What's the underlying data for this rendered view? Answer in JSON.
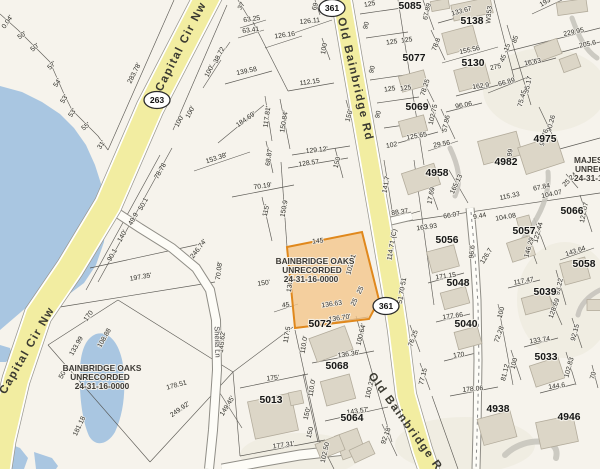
{
  "map": {
    "palette": {
      "background": "#f6f3ec",
      "road_fill": "#f2eda1",
      "road_casing": "#9a9890",
      "water": "#a9c6e1",
      "selected_fill": "#f4c488",
      "selected_border": "#e0881c",
      "building_fill": "#dcd6c7"
    },
    "roads": {
      "capital_cir": {
        "name": "Capital Cir Nw",
        "shield": "263"
      },
      "old_bainbridge": {
        "name": "Old Bainbridge Rd",
        "shield": "361"
      },
      "sheila_ln": {
        "name": "Sheila Ln"
      }
    },
    "subdivisions": {
      "bainbridge_oaks": {
        "line1": "BAINBRIDGE OAKS",
        "line2": "UNRECORDED",
        "line3": "24-31-16-0000"
      },
      "majestic": {
        "line1": "MAJESTIC",
        "line2": "UNRECORDED",
        "line3": "24-31-16-0000"
      }
    },
    "selected_parcel": {
      "dimensions": [
        "145",
        "102.21",
        "25",
        "25",
        "136.63",
        "130.1"
      ]
    },
    "parcel_numbers": [
      {
        "t": "5085",
        "x": 410,
        "y": 9
      },
      {
        "t": "5138",
        "x": 472,
        "y": 24
      },
      {
        "t": "5077",
        "x": 414,
        "y": 61
      },
      {
        "t": "5130",
        "x": 473,
        "y": 66
      },
      {
        "t": "5069",
        "x": 417,
        "y": 110
      },
      {
        "t": "4982",
        "x": 506,
        "y": 165
      },
      {
        "t": "4975",
        "x": 545,
        "y": 142
      },
      {
        "t": "5066",
        "x": 572,
        "y": 214
      },
      {
        "t": "4958",
        "x": 437,
        "y": 176
      },
      {
        "t": "5057",
        "x": 524,
        "y": 234
      },
      {
        "t": "5056",
        "x": 447,
        "y": 243
      },
      {
        "t": "5058",
        "x": 584,
        "y": 267
      },
      {
        "t": "5048",
        "x": 458,
        "y": 286
      },
      {
        "t": "5039",
        "x": 545,
        "y": 295
      },
      {
        "t": "5040",
        "x": 466,
        "y": 327
      },
      {
        "t": "5033",
        "x": 546,
        "y": 360
      },
      {
        "t": "4938",
        "x": 498,
        "y": 412
      },
      {
        "t": "4946",
        "x": 569,
        "y": 420
      },
      {
        "t": "5072",
        "x": 320,
        "y": 327
      },
      {
        "t": "5068",
        "x": 337,
        "y": 369
      },
      {
        "t": "5064",
        "x": 352,
        "y": 421
      },
      {
        "t": "5013",
        "x": 271,
        "y": 403
      }
    ],
    "measurements": [
      {
        "t": "0.04'",
        "x": 9,
        "y": 23,
        "r": -55
      },
      {
        "t": "50'",
        "x": 23,
        "y": 37,
        "r": -35
      },
      {
        "t": "50'",
        "x": 36,
        "y": 49,
        "r": -40
      },
      {
        "t": "57'",
        "x": 53,
        "y": 67,
        "r": -42
      },
      {
        "t": "54'",
        "x": 59,
        "y": 84,
        "r": -55
      },
      {
        "t": "53'",
        "x": 66,
        "y": 100,
        "r": -58
      },
      {
        "t": "53'",
        "x": 74,
        "y": 114,
        "r": -55
      },
      {
        "t": "55'",
        "x": 87,
        "y": 128,
        "r": -38
      },
      {
        "t": "31'",
        "x": 103,
        "y": 146,
        "r": -55
      },
      {
        "t": "283.78'",
        "x": 136,
        "y": 74,
        "r": -63
      },
      {
        "t": "100'",
        "x": 181,
        "y": 122,
        "r": -63
      },
      {
        "t": "100'",
        "x": 192,
        "y": 113,
        "r": -63
      },
      {
        "t": "38.72",
        "x": 221,
        "y": 56,
        "r": -63
      },
      {
        "t": "100'",
        "x": 211,
        "y": 72,
        "r": -63
      },
      {
        "t": "37",
        "x": 243,
        "y": 7,
        "r": -60
      },
      {
        "t": "63.25",
        "x": 252,
        "y": 21,
        "r": -8
      },
      {
        "t": "63.41",
        "x": 251,
        "y": 32,
        "r": -8
      },
      {
        "t": "126.11",
        "x": 310,
        "y": 23,
        "r": -6
      },
      {
        "t": "126.16",
        "x": 285,
        "y": 37,
        "r": -8
      },
      {
        "t": "69",
        "x": 317,
        "y": 7,
        "r": -75
      },
      {
        "t": "100",
        "x": 326,
        "y": 49,
        "r": -80
      },
      {
        "t": "139.58",
        "x": 247,
        "y": 73,
        "r": -12
      },
      {
        "t": "112.15",
        "x": 310,
        "y": 84,
        "r": -8
      },
      {
        "t": "184.69'",
        "x": 247,
        "y": 121,
        "r": -35
      },
      {
        "t": "117.81'",
        "x": 269,
        "y": 117,
        "r": -82
      },
      {
        "t": "150.84'",
        "x": 286,
        "y": 122,
        "r": -80
      },
      {
        "t": "150'",
        "x": 351,
        "y": 116,
        "r": -75
      },
      {
        "t": "68.87'",
        "x": 271,
        "y": 157,
        "r": -82
      },
      {
        "t": "129.12'",
        "x": 317,
        "y": 152,
        "r": -6
      },
      {
        "t": "128.57",
        "x": 309,
        "y": 165,
        "r": -8
      },
      {
        "t": "150",
        "x": 339,
        "y": 163,
        "r": -75
      },
      {
        "t": "153.38'",
        "x": 217,
        "y": 160,
        "r": -18
      },
      {
        "t": "70.19'",
        "x": 263,
        "y": 188,
        "r": -8
      },
      {
        "t": "115'",
        "x": 268,
        "y": 211,
        "r": -77
      },
      {
        "t": "150.9",
        "x": 286,
        "y": 209,
        "r": -80
      },
      {
        "t": "246.74'",
        "x": 200,
        "y": 250,
        "r": -52
      },
      {
        "t": "70.08'",
        "x": 221,
        "y": 271,
        "r": -83
      },
      {
        "t": "145.62'",
        "x": 224,
        "y": 342,
        "r": -84
      },
      {
        "t": "197.35'",
        "x": 141,
        "y": 279,
        "r": -10
      },
      {
        "t": "78.78",
        "x": 162,
        "y": 172,
        "r": -60
      },
      {
        "t": "50.1",
        "x": 145,
        "y": 205,
        "r": -60
      },
      {
        "t": "49.9",
        "x": 135,
        "y": 220,
        "r": -60
      },
      {
        "t": "140'",
        "x": 124,
        "y": 237,
        "r": -60
      },
      {
        "t": "90.1",
        "x": 114,
        "y": 256,
        "r": -60
      },
      {
        "t": "170",
        "x": 90,
        "y": 317,
        "r": -55
      },
      {
        "t": "108.88",
        "x": 106,
        "y": 339,
        "r": -60
      },
      {
        "t": "133.99",
        "x": 78,
        "y": 347,
        "r": -60
      },
      {
        "t": "50",
        "x": 64,
        "y": 376,
        "r": -60
      },
      {
        "t": "178.51",
        "x": 177,
        "y": 387,
        "r": -15
      },
      {
        "t": "249.92'",
        "x": 181,
        "y": 411,
        "r": -35
      },
      {
        "t": "181.18",
        "x": 81,
        "y": 427,
        "r": -65
      },
      {
        "t": "150'",
        "x": 264,
        "y": 285,
        "r": -8
      },
      {
        "t": "45",
        "x": 286,
        "y": 307,
        "r": -8
      },
      {
        "t": "117.5",
        "x": 289,
        "y": 335,
        "r": -80
      },
      {
        "t": "175'",
        "x": 273,
        "y": 380,
        "r": -6
      },
      {
        "t": "149.45'",
        "x": 229,
        "y": 407,
        "r": -58
      },
      {
        "t": "177.31'",
        "x": 284,
        "y": 447,
        "r": -8
      },
      {
        "t": "145",
        "x": 318,
        "y": 243,
        "r": -6
      },
      {
        "t": "102.21",
        "x": 353,
        "y": 265,
        "r": -75
      },
      {
        "t": "130.1",
        "x": 292,
        "y": 284,
        "r": -82
      },
      {
        "t": "136.63",
        "x": 332,
        "y": 306,
        "r": -8
      },
      {
        "t": "25",
        "x": 362,
        "y": 291,
        "r": -62
      },
      {
        "t": "25",
        "x": 356,
        "y": 303,
        "r": -62
      },
      {
        "t": "141.7",
        "x": 388,
        "y": 185,
        "r": -80
      },
      {
        "t": "88.37",
        "x": 400,
        "y": 214,
        "r": -8
      },
      {
        "t": "114.71 (C)",
        "x": 394,
        "y": 245,
        "r": -80
      },
      {
        "t": "51 70 51",
        "x": 404,
        "y": 291,
        "r": -80
      },
      {
        "t": "102",
        "x": 392,
        "y": 147,
        "r": -10
      },
      {
        "t": "136.70'",
        "x": 340,
        "y": 320,
        "r": -8
      },
      {
        "t": "100.64'",
        "x": 363,
        "y": 335,
        "r": -76
      },
      {
        "t": "136.36'",
        "x": 349,
        "y": 356,
        "r": -8
      },
      {
        "t": "110.0'",
        "x": 306,
        "y": 345,
        "r": -80
      },
      {
        "t": "110.0'",
        "x": 314,
        "y": 388,
        "r": -80
      },
      {
        "t": "100.22'",
        "x": 372,
        "y": 388,
        "r": -76
      },
      {
        "t": "143.57'",
        "x": 358,
        "y": 413,
        "r": -8
      },
      {
        "t": "92.18'",
        "x": 388,
        "y": 436,
        "r": -70
      },
      {
        "t": "102.50",
        "x": 327,
        "y": 453,
        "r": -77
      },
      {
        "t": "150'",
        "x": 309,
        "y": 414,
        "r": -76
      },
      {
        "t": "150",
        "x": 312,
        "y": 433,
        "r": -76
      },
      {
        "t": "125",
        "x": 370,
        "y": 6,
        "r": -10
      },
      {
        "t": "90",
        "x": 368,
        "y": 26,
        "r": -75
      },
      {
        "t": "125",
        "x": 392,
        "y": 44,
        "r": -8
      },
      {
        "t": "90",
        "x": 374,
        "y": 70,
        "r": -75
      },
      {
        "t": "125",
        "x": 390,
        "y": 91,
        "r": -8
      },
      {
        "t": "90",
        "x": 380,
        "y": 115,
        "r": -75
      },
      {
        "t": "67.89",
        "x": 429,
        "y": 12,
        "r": -77
      },
      {
        "t": "133.67",
        "x": 462,
        "y": 13,
        "r": -15
      },
      {
        "t": "78.8",
        "x": 438,
        "y": 45,
        "r": -70
      },
      {
        "t": "155.56",
        "x": 470,
        "y": 52,
        "r": -12
      },
      {
        "t": "78.25",
        "x": 427,
        "y": 88,
        "r": -72
      },
      {
        "t": "102.75",
        "x": 435,
        "y": 115,
        "r": -77
      },
      {
        "t": "57.86",
        "x": 448,
        "y": 124,
        "r": -78
      },
      {
        "t": "96.06",
        "x": 464,
        "y": 107,
        "r": -10
      },
      {
        "t": "162.9",
        "x": 481,
        "y": 88,
        "r": -8
      },
      {
        "t": "66.89",
        "x": 507,
        "y": 84,
        "r": -15
      },
      {
        "t": "125",
        "x": 407,
        "y": 42,
        "r": -8
      },
      {
        "t": "125",
        "x": 406,
        "y": 90,
        "r": -8
      },
      {
        "t": "125.65",
        "x": 417,
        "y": 138,
        "r": -10
      },
      {
        "t": "29.56",
        "x": 442,
        "y": 146,
        "r": -10
      },
      {
        "t": "193",
        "x": 546,
        "y": 4,
        "r": -30
      },
      {
        "t": "229.95",
        "x": 574,
        "y": 34,
        "r": -12
      },
      {
        "t": "205.6",
        "x": 588,
        "y": 46,
        "r": -12
      },
      {
        "t": "16 63",
        "x": 533,
        "y": 64,
        "r": -10
      },
      {
        "t": "95.17",
        "x": 530,
        "y": 85,
        "r": -78
      },
      {
        "t": "75.45",
        "x": 524,
        "y": 99,
        "r": -75
      },
      {
        "t": "90.26",
        "x": 553,
        "y": 124,
        "r": -75
      },
      {
        "t": "90.76",
        "x": 546,
        "y": 138,
        "r": -75
      },
      {
        "t": "85",
        "x": 517,
        "y": 40,
        "r": -70
      },
      {
        "t": "15",
        "x": 509,
        "y": 48,
        "r": -70
      },
      {
        "t": "45",
        "x": 505,
        "y": 59,
        "r": -70
      },
      {
        "t": "275",
        "x": 496,
        "y": 69,
        "r": -12
      },
      {
        "t": "W353",
        "x": 491,
        "y": 15,
        "r": -85
      },
      {
        "t": "99",
        "x": 512,
        "y": 153,
        "r": -80
      },
      {
        "t": "165.13",
        "x": 458,
        "y": 185,
        "r": -65
      },
      {
        "t": "17.69",
        "x": 433,
        "y": 196,
        "r": -80
      },
      {
        "t": "163.93",
        "x": 427,
        "y": 229,
        "r": -8
      },
      {
        "t": "66.07",
        "x": 452,
        "y": 217,
        "r": -10
      },
      {
        "t": "9.44",
        "x": 480,
        "y": 218,
        "r": -10
      },
      {
        "t": "104.08",
        "x": 506,
        "y": 219,
        "r": -10
      },
      {
        "t": "115.33",
        "x": 510,
        "y": 198,
        "r": -12
      },
      {
        "t": "67.84",
        "x": 542,
        "y": 189,
        "r": -12
      },
      {
        "t": "104.07",
        "x": 552,
        "y": 196,
        "r": -12
      },
      {
        "t": "25 24",
        "x": 571,
        "y": 181,
        "r": -45
      },
      {
        "t": "122.07",
        "x": 586,
        "y": 213,
        "r": -78
      },
      {
        "t": "122.44",
        "x": 540,
        "y": 233,
        "r": -75
      },
      {
        "t": "146.29",
        "x": 531,
        "y": 248,
        "r": -75
      },
      {
        "t": "143.64",
        "x": 576,
        "y": 253,
        "r": -18
      },
      {
        "t": "96.6",
        "x": 474,
        "y": 252,
        "r": -85
      },
      {
        "t": "126.7",
        "x": 488,
        "y": 257,
        "r": -58
      },
      {
        "t": "171.15",
        "x": 446,
        "y": 278,
        "r": -8
      },
      {
        "t": "117.47",
        "x": 524,
        "y": 283,
        "r": -10
      },
      {
        "t": "93.22",
        "x": 561,
        "y": 287,
        "r": -78
      },
      {
        "t": "177.66",
        "x": 453,
        "y": 318,
        "r": -8
      },
      {
        "t": "76.25",
        "x": 415,
        "y": 339,
        "r": -70
      },
      {
        "t": "170",
        "x": 459,
        "y": 357,
        "r": -8
      },
      {
        "t": "77.15",
        "x": 425,
        "y": 377,
        "r": -76
      },
      {
        "t": "178.06",
        "x": 473,
        "y": 391,
        "r": -5
      },
      {
        "t": "100",
        "x": 503,
        "y": 313,
        "r": -75
      },
      {
        "t": "72.28",
        "x": 501,
        "y": 335,
        "r": -70
      },
      {
        "t": "81.12",
        "x": 507,
        "y": 373,
        "r": -76
      },
      {
        "t": "100",
        "x": 516,
        "y": 364,
        "r": -76
      },
      {
        "t": "133.74",
        "x": 540,
        "y": 342,
        "r": -8
      },
      {
        "t": "128.69",
        "x": 556,
        "y": 309,
        "r": -70
      },
      {
        "t": "92.15",
        "x": 577,
        "y": 333,
        "r": -75
      },
      {
        "t": "102.83",
        "x": 571,
        "y": 368,
        "r": -75
      },
      {
        "t": "70",
        "x": 595,
        "y": 376,
        "r": -75
      },
      {
        "t": "144.6",
        "x": 557,
        "y": 388,
        "r": -8
      }
    ]
  }
}
